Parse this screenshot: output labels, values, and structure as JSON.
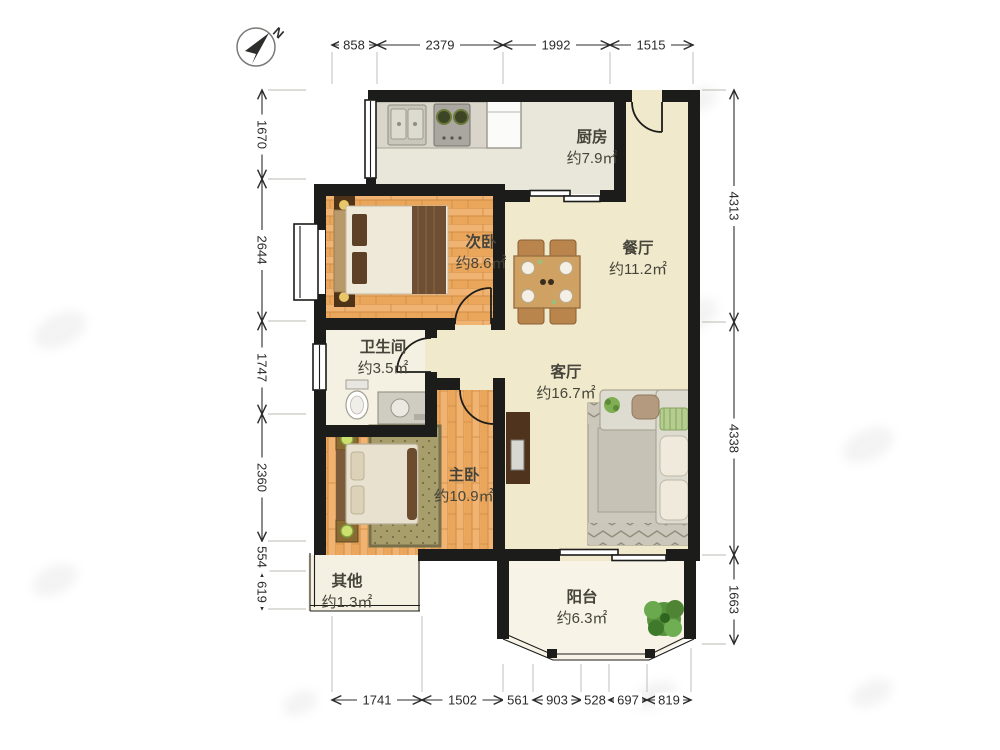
{
  "compass": {
    "north_label": "N"
  },
  "rooms": {
    "kitchen": {
      "name": "厨房",
      "area": "约7.9㎡"
    },
    "second_bedroom": {
      "name": "次卧",
      "area": "约8.6㎡"
    },
    "dining": {
      "name": "餐厅",
      "area": "约11.2㎡"
    },
    "bathroom": {
      "name": "卫生间",
      "area": "约3.5㎡"
    },
    "living": {
      "name": "客厅",
      "area": "约16.7㎡"
    },
    "master_bedroom": {
      "name": "主卧",
      "area": "约10.9㎡"
    },
    "other": {
      "name": "其他",
      "area": "约1.3㎡"
    },
    "balcony": {
      "name": "阳台",
      "area": "约6.3㎡"
    }
  },
  "dimensions": {
    "top": [
      "858",
      "2379",
      "1992",
      "1515"
    ],
    "left": [
      "1670",
      "2644",
      "1747",
      "2360",
      "554",
      "619"
    ],
    "right": [
      "4313",
      "4338",
      "1663"
    ],
    "bottom": [
      "1741",
      "1502",
      "561",
      "903",
      "528",
      "697",
      "819"
    ]
  },
  "colors": {
    "wall": "#1c1c1a",
    "floor_main": "#f0e9cc",
    "floor_kitchen": "#e9e6da",
    "floor_cream": "#f5f1e2",
    "wood": "#eaa75c"
  }
}
